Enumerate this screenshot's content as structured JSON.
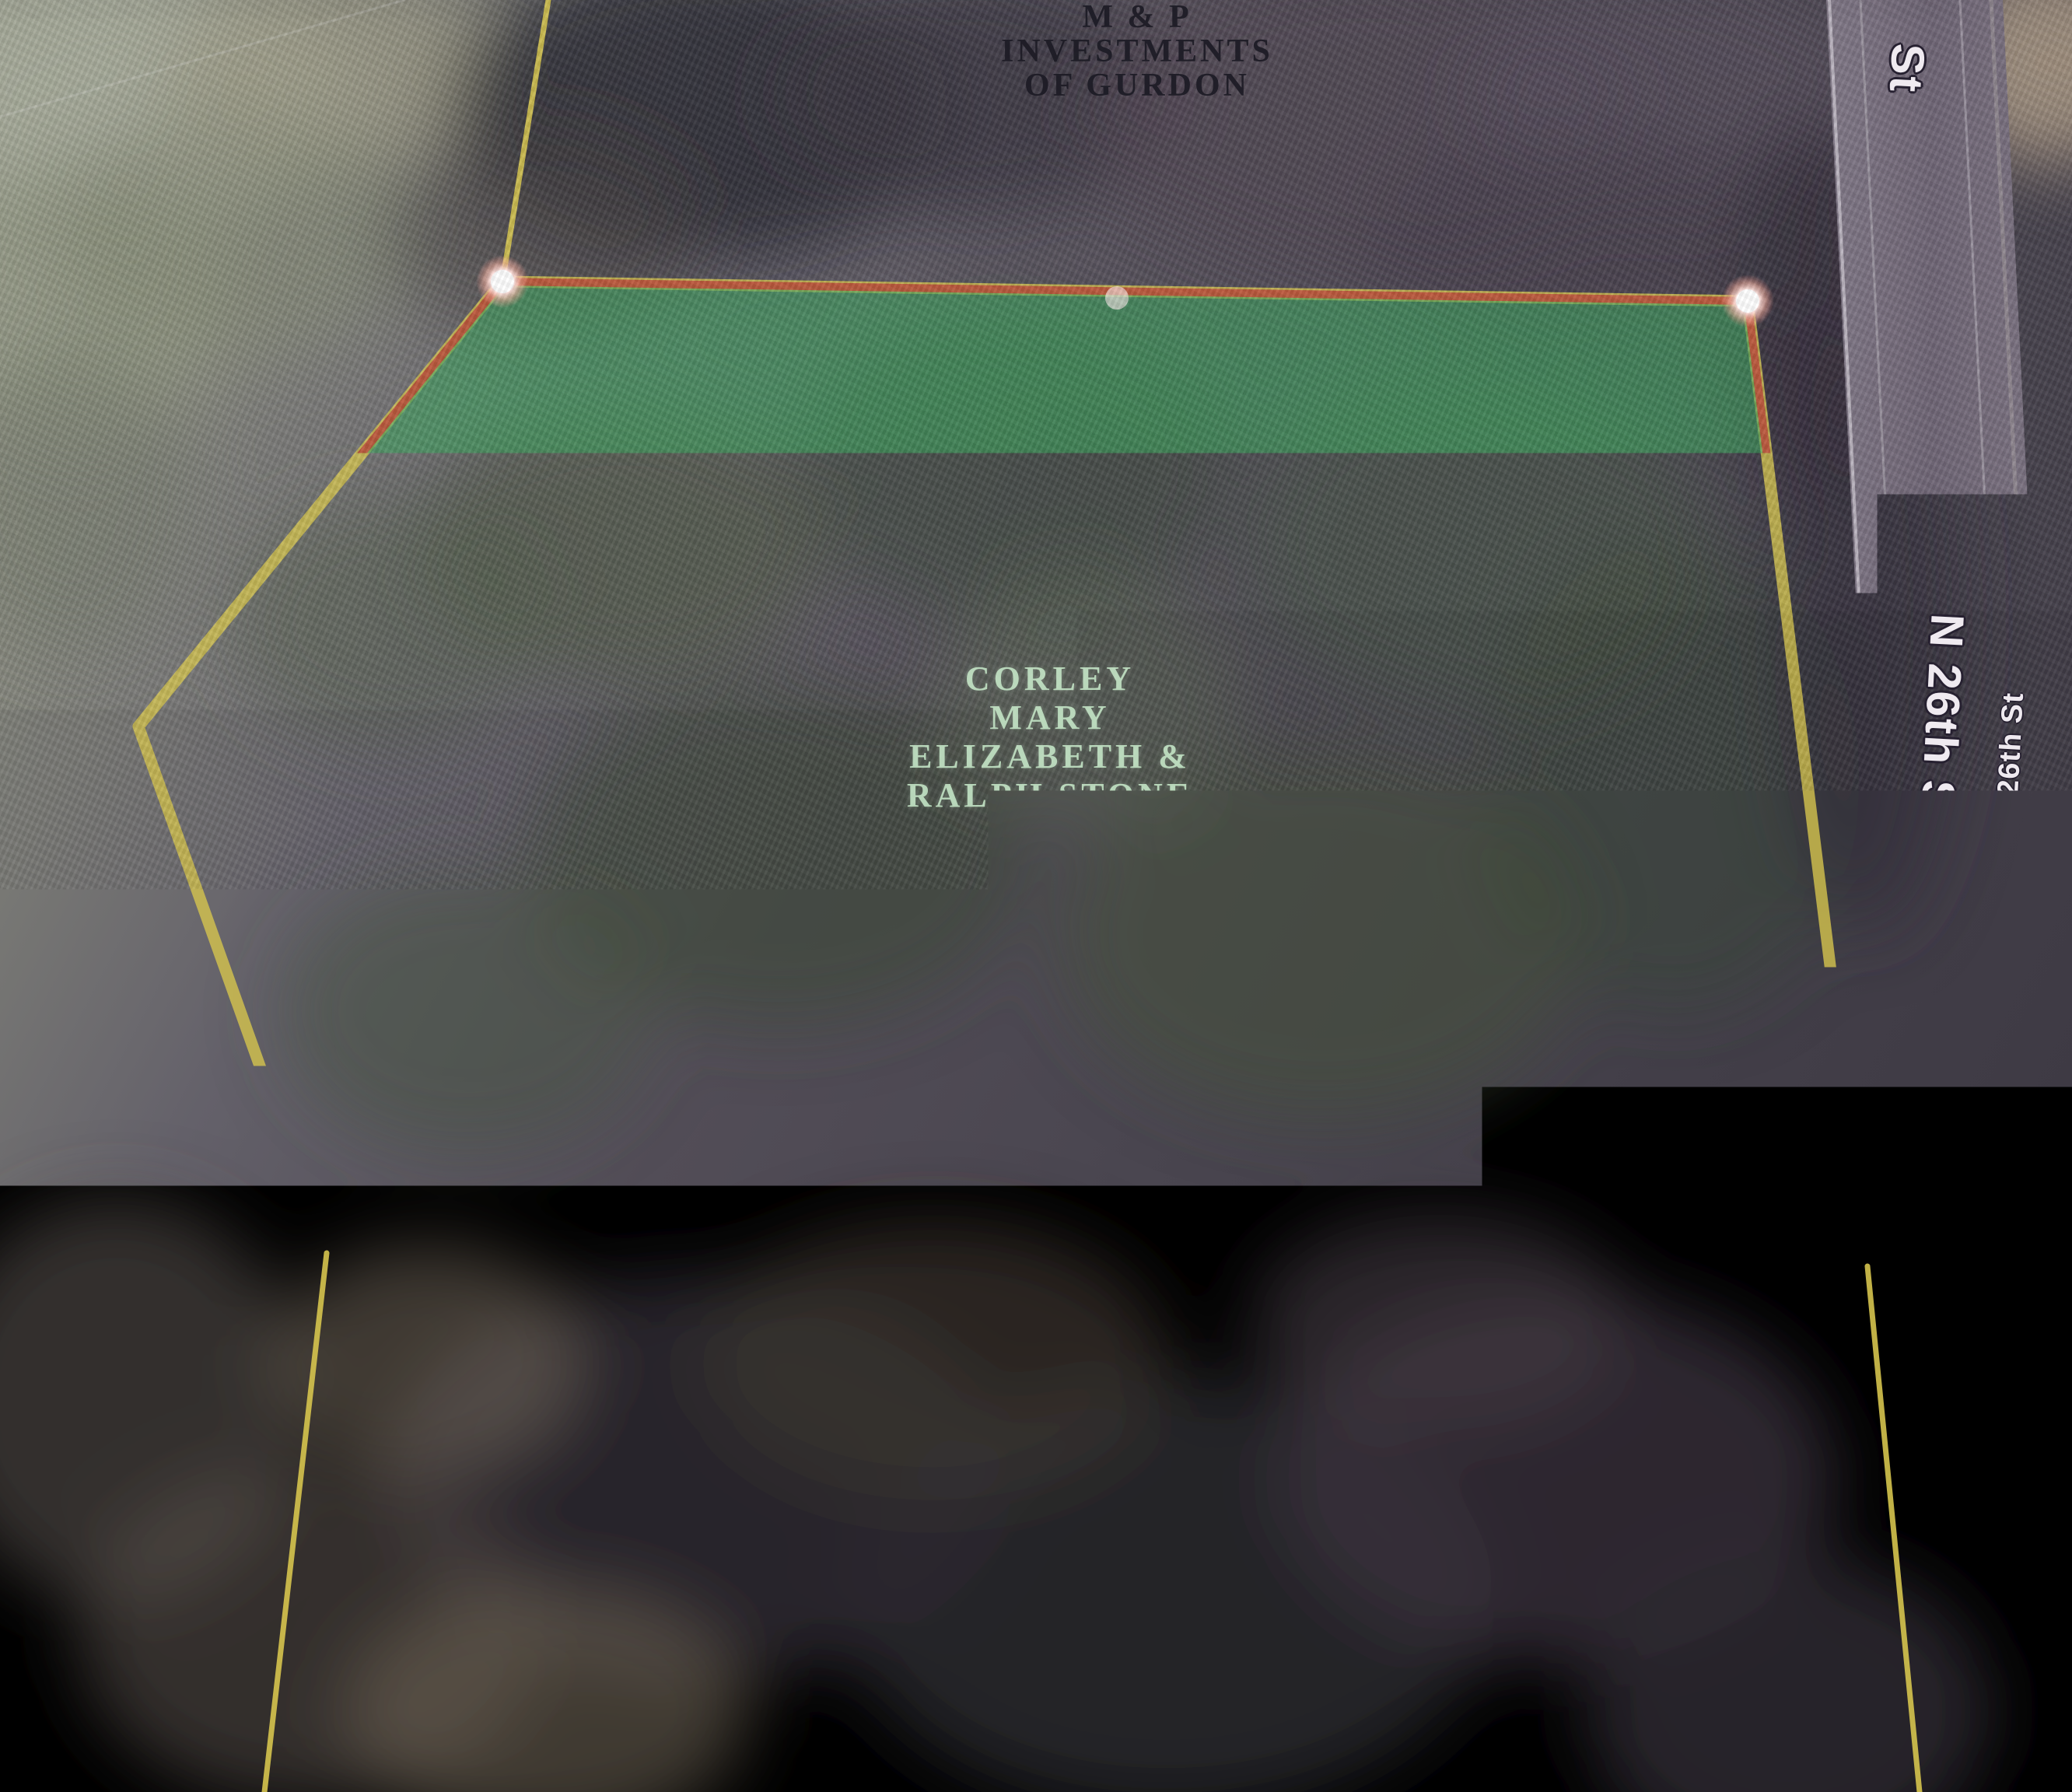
{
  "map": {
    "type": "aerial-parcel-map",
    "watermark": "CARMLS, INC",
    "selected_parcel": {
      "owner_lines": [
        "CORLEY",
        "MARY",
        "ELIZABETH &",
        "RALPH STONE",
        "MANN"
      ]
    },
    "neighbor_parcel_north": {
      "owner_lines": [
        "M & P",
        "INVESTMENTS",
        "OF GURDON"
      ]
    },
    "neighbor_parcel_south": {
      "owner_lines": [
        "BALLARD",
        "LEROY &",
        "TAMARA"
      ],
      "address_number": "905"
    },
    "streets": {
      "partial_top": "St",
      "n26_upper": "N 26th St",
      "n26_upper_small": "N 26th St",
      "n26_lower": "N 26th St"
    },
    "colors": {
      "parcel_fill": "#3aa05c",
      "parcel_boundary": "#b8503a",
      "adjacent_parcel_line": "#d6c44e",
      "vertex": "#ffffff",
      "road": "#6c6472"
    }
  }
}
